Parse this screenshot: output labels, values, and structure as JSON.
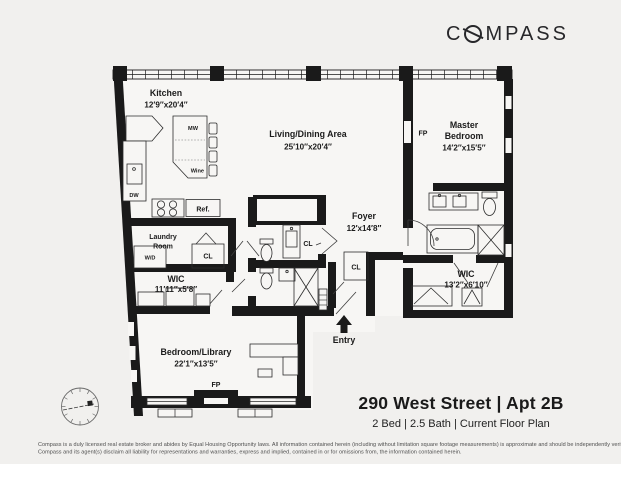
{
  "brand": {
    "name": "COMPASS",
    "logo_prefix": "C",
    "logo_suffix": "MPASS",
    "logo_color": "#27272a"
  },
  "colors": {
    "page_background": "#f1f0ee",
    "floor_fill": "#f7f6f4",
    "wall": "#1a1a1a"
  },
  "rooms": {
    "kitchen": {
      "name": "Kitchen",
      "dims": "12′9″x20′4″"
    },
    "living_dining": {
      "name": "Living/Dining Area",
      "dims": "25′10″x20′4″"
    },
    "master_bedroom": {
      "line1": "Master",
      "line2": "Bedroom",
      "dims": "14′2″x15′5″"
    },
    "foyer": {
      "name": "Foyer",
      "dims": "12′x14′8″"
    },
    "laundry": {
      "line1": "Laundry",
      "line2": "Room"
    },
    "wic_small": {
      "name": "WIC",
      "dims": "11′11″x5′8″"
    },
    "wic_master": {
      "name": "WIC",
      "dims": "13′2″x6′10″"
    },
    "bedroom_library": {
      "name": "Bedroom/Library",
      "dims": "22′1″x13′5″"
    }
  },
  "labels": {
    "mw": "MW",
    "wine": "Wine",
    "dw": "DW",
    "ref": "Ref.",
    "wd": "W/D",
    "cl": "CL",
    "fp": "FP",
    "entry": "Entry"
  },
  "listing": {
    "title": "290 West Street | Apt 2B",
    "subtitle": "2 Bed | 2.5 Bath | Current Floor Plan"
  },
  "disclaimer": {
    "line1": "Compass is a duly licensed real estate broker and abides by Equal Housing Opportunity laws.  All information contained herein (including without limitation square footage measurements) is approximate and should be independently verified.",
    "line2": "Compass and its agent(s) disclaim all liability for representations and warranties, express and implied, contained in or for omissions from, the information contained herein."
  }
}
